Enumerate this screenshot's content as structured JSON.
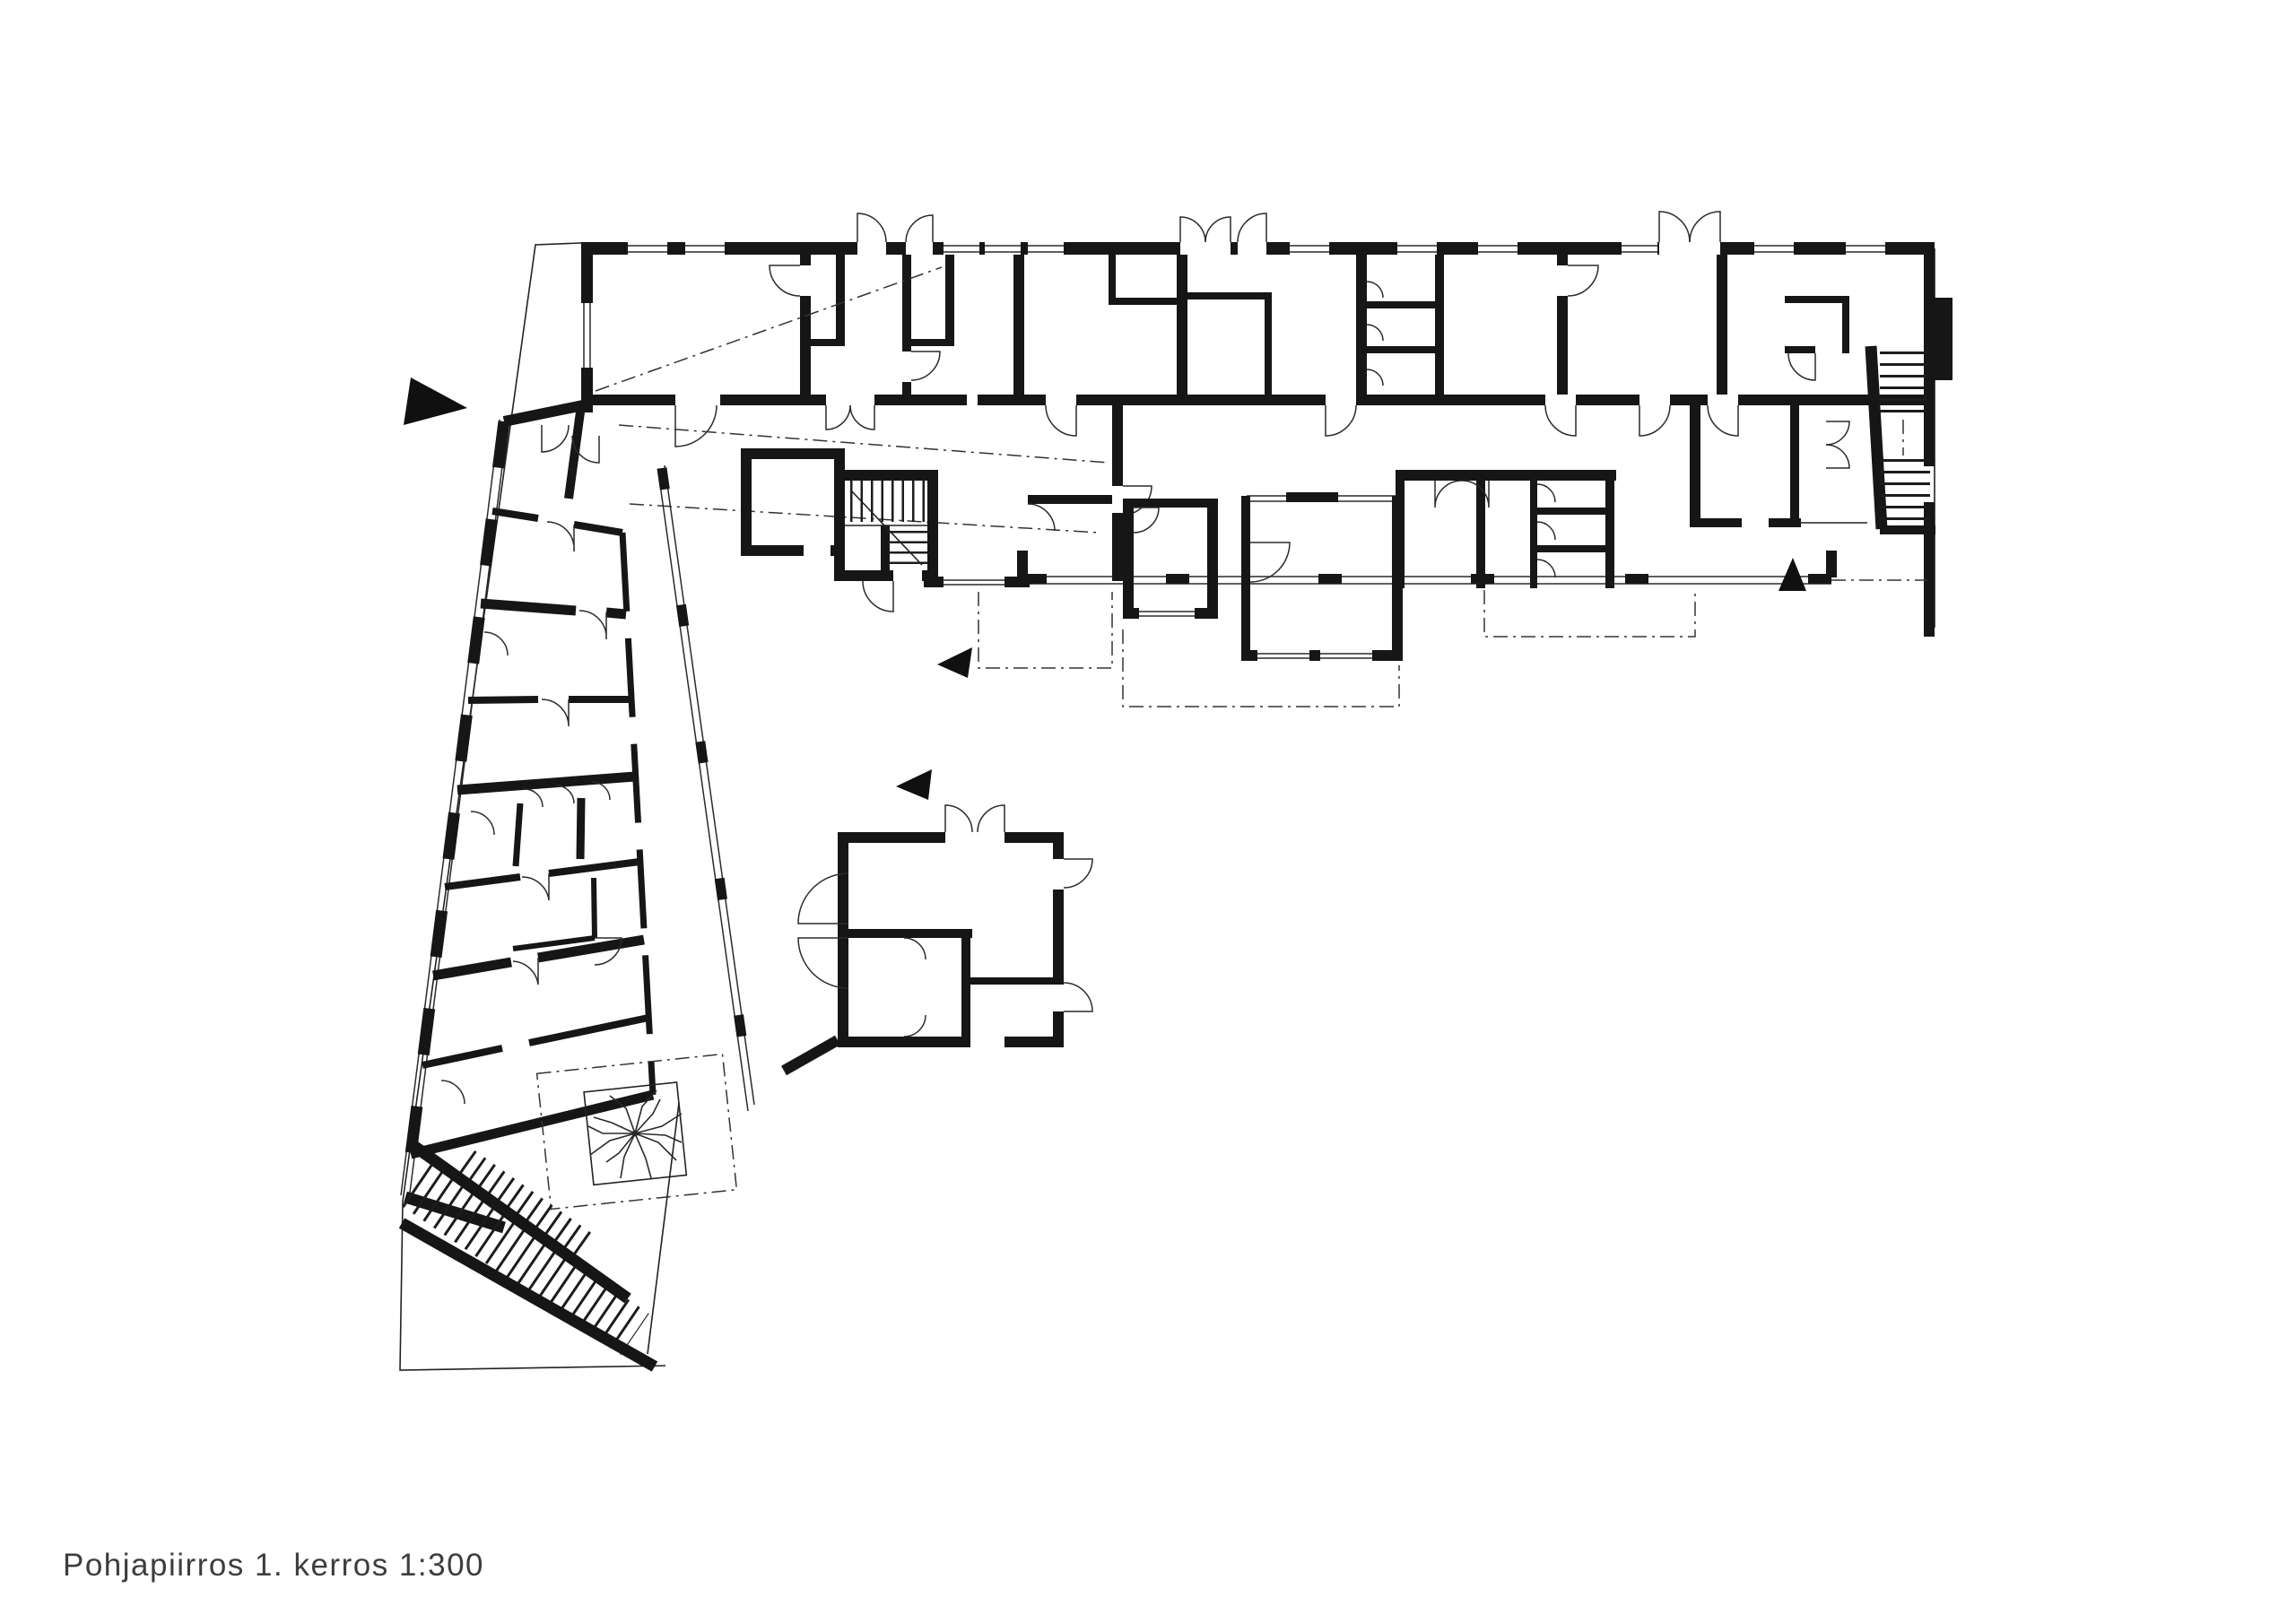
{
  "document": {
    "type": "architectural floor plan drawing",
    "caption": "Pohjapiirros 1. kerros 1:300",
    "drawing_title": "Pohjapiirros",
    "floor_label": "1. kerros",
    "scale_label": "1:300",
    "background_color": "#ffffff",
    "ink_color": "#161616"
  },
  "markers": {
    "west_entrance_arrow": {
      "shape": "solid-triangle",
      "points": "east"
    },
    "court_entrance_arrow_upper": {
      "shape": "solid-triangle",
      "points": "west"
    },
    "court_entrance_arrow_lower": {
      "shape": "solid-triangle",
      "points": "west"
    },
    "south_entrance_arrow": {
      "shape": "solid-triangle",
      "points": "north"
    }
  },
  "symbols": {
    "tree": "courtyard tree in planter with dashed terrace outline",
    "stairs": [
      "main-stair-core",
      "east-exterior-stair",
      "south-ramp-stair"
    ],
    "doors": "quarter-circle swing arcs",
    "windows": "double glazing lines in wall openings",
    "reference_lines": "dash-dot sight/canopy lines"
  }
}
